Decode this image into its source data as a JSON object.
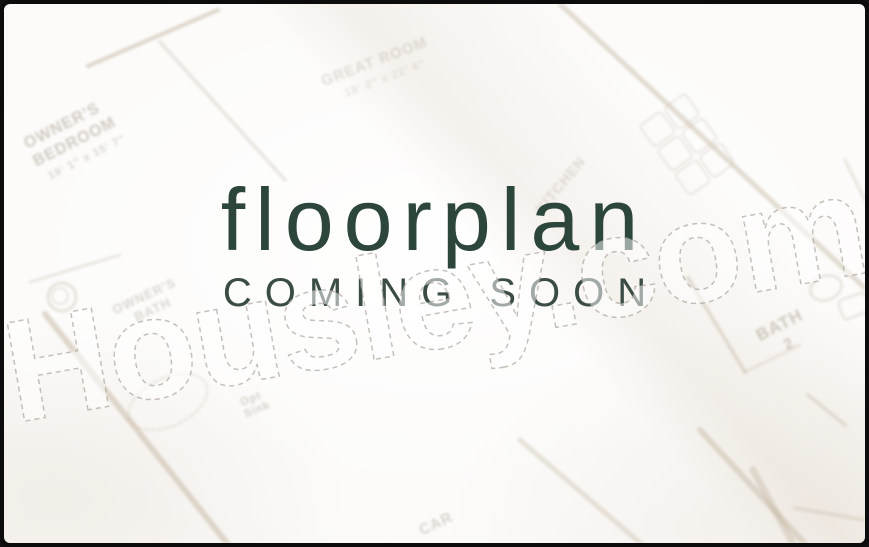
{
  "placeholder": {
    "title": "floorplan",
    "subtitle": "COMING SOON"
  },
  "watermark": {
    "text": "Housley.com"
  },
  "floorplan": {
    "labels": {
      "owners_bedroom_line1": "OWNER'S",
      "owners_bedroom_line2": "BEDROOM",
      "owners_bedroom_dims": "19' 1\" x 15' 7\"",
      "great_room": "GREAT ROOM",
      "great_room_dims": "19' 2\" x 22' 6\"",
      "kitchen": "KITCHEN",
      "bath": "BATH",
      "bath_number": "2",
      "owners_bath_line1": "OWNER'S",
      "owners_bath_line2": "BATH",
      "opt_sink_line1": "Opt",
      "opt_sink_line2": "Sink",
      "garage": "CAR"
    }
  },
  "colors": {
    "title_green": "#2c463c",
    "subtitle_green": "#3a4c44",
    "plan_line_tan": "#c3b5a1",
    "frame_black": "#0c0c0c",
    "background": "#fbfaf8"
  }
}
